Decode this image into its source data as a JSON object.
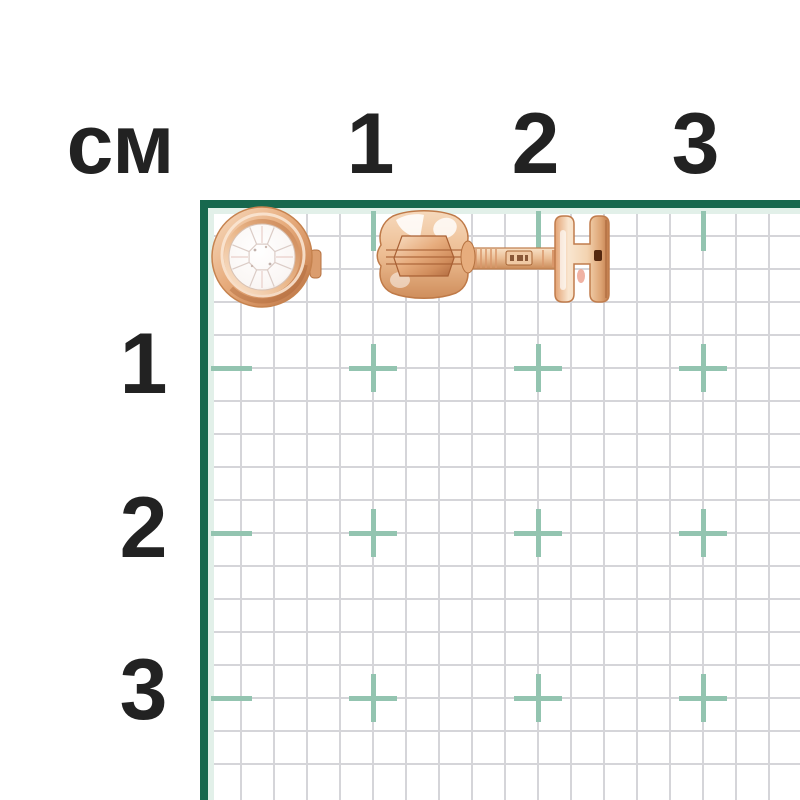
{
  "page": {
    "kind": "product-size-reference-photo",
    "subject": "gold stud earring with round bezel-set diamond, front view and screw-back side view, on centimeter graph grid"
  },
  "ruler": {
    "unit_label": "см",
    "top_ticks": [
      "1",
      "2",
      "3"
    ],
    "left_ticks": [
      "1",
      "2",
      "3"
    ]
  },
  "grid": {
    "minor_cell_px": 33,
    "major_every_cells": 5,
    "has_top_border": true,
    "has_left_border": true
  },
  "colors": {
    "border_green": "#17684e",
    "mint_strip": "#e2f0e9",
    "cross_teal": "#93c4b0",
    "grid_line_gray": "#d5d5d9",
    "label_black": "#222222",
    "gold_mid": "#e2a476",
    "gold_light": "#f8e0c6",
    "gold_dark": "#b06a3f",
    "diamond_white": "#fdfbfa"
  }
}
